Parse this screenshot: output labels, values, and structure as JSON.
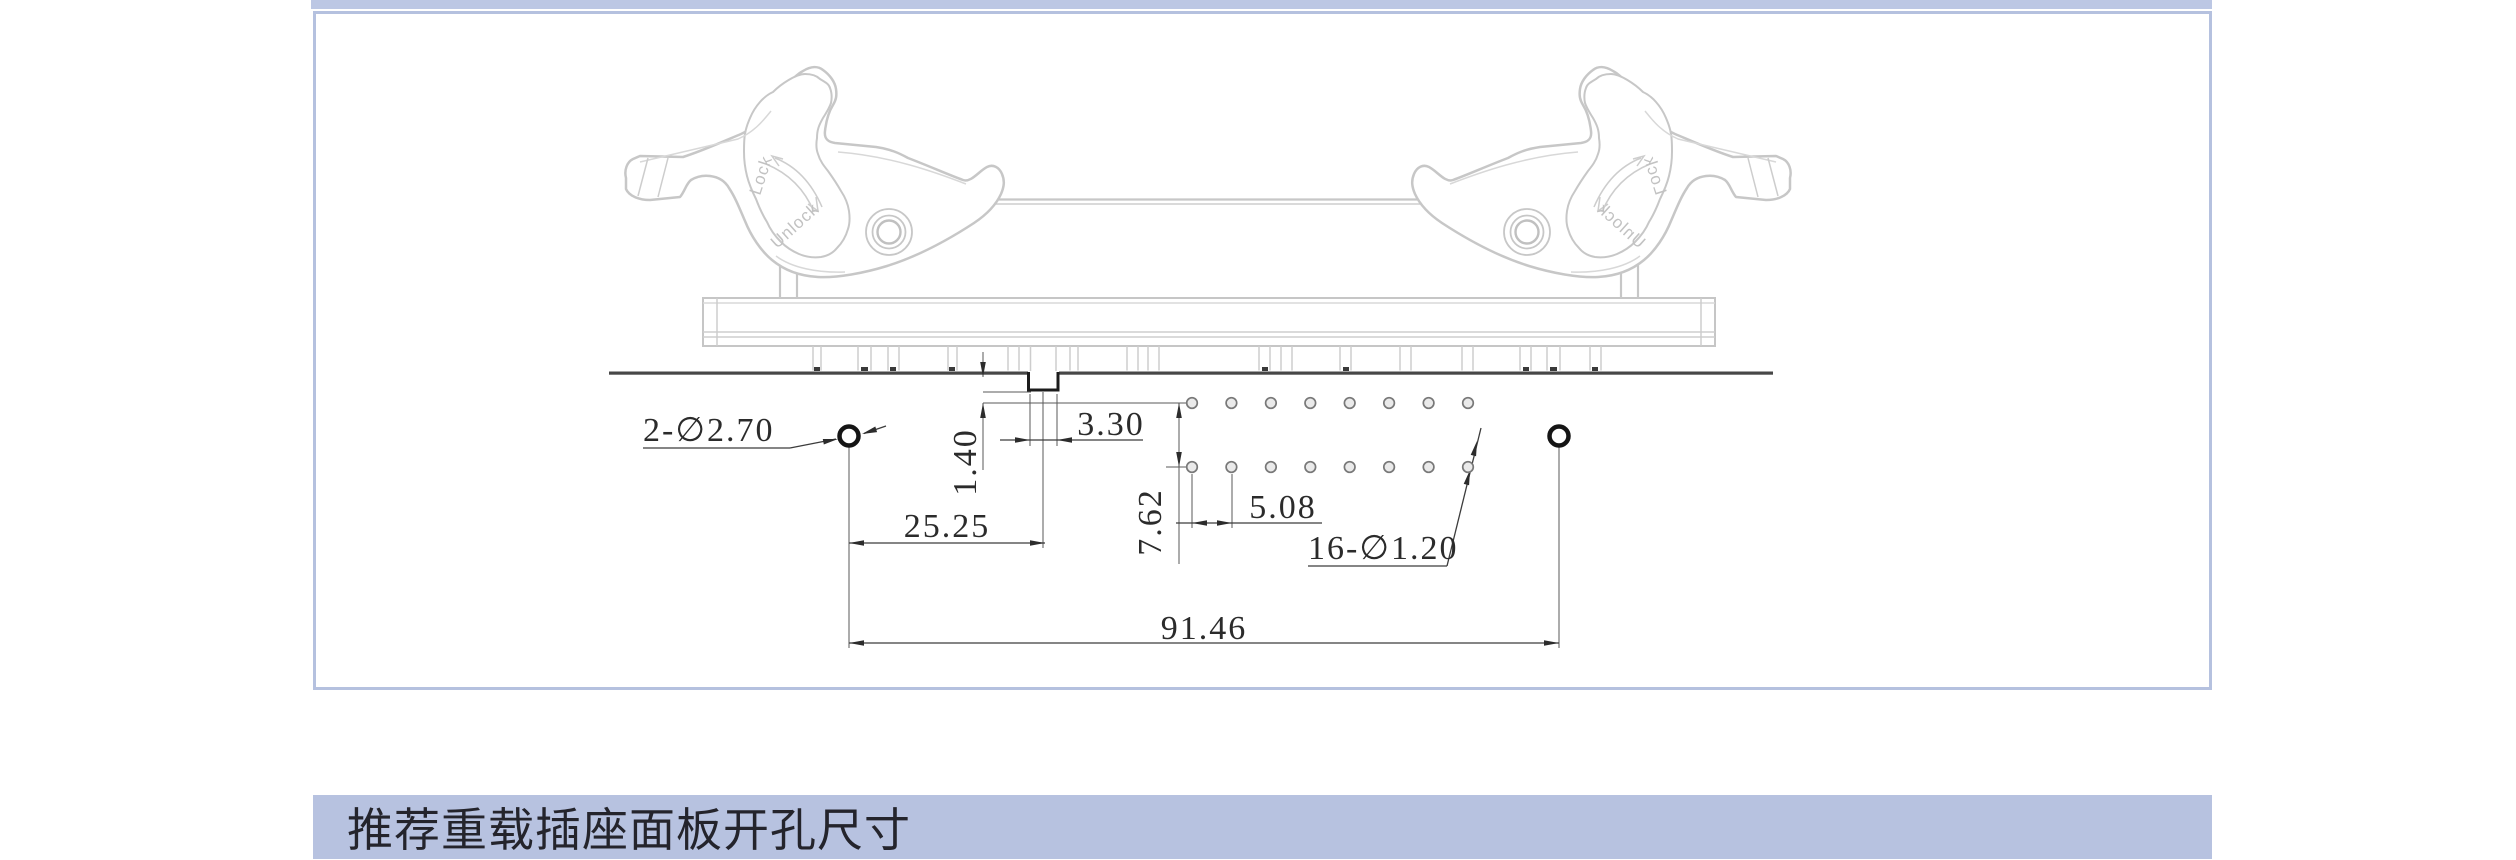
{
  "section_header": {
    "title": "推荐重载插座面板开孔尺寸"
  },
  "drawing": {
    "lever_labels": {
      "lock": "Lock",
      "unlock": "Unlock"
    },
    "dimensions": {
      "mounting_holes_label": "2-∅2.70",
      "slot_width": "3.30",
      "slot_offset": "1.40",
      "hole_to_center": "25.25",
      "row_pitch": "7.62",
      "pin_pitch": "5.08",
      "pin_holes_label": "16-∅1.20",
      "hole_span": "91.46"
    }
  },
  "colors": {
    "band": "#b7c2e0",
    "top_strip": "#bcc7e4",
    "panel_border": "#b5c1df",
    "drawing_gray": "#c7c7c7",
    "dim_color": "#2b2b2b",
    "panel_edge_dark": "#474747"
  }
}
